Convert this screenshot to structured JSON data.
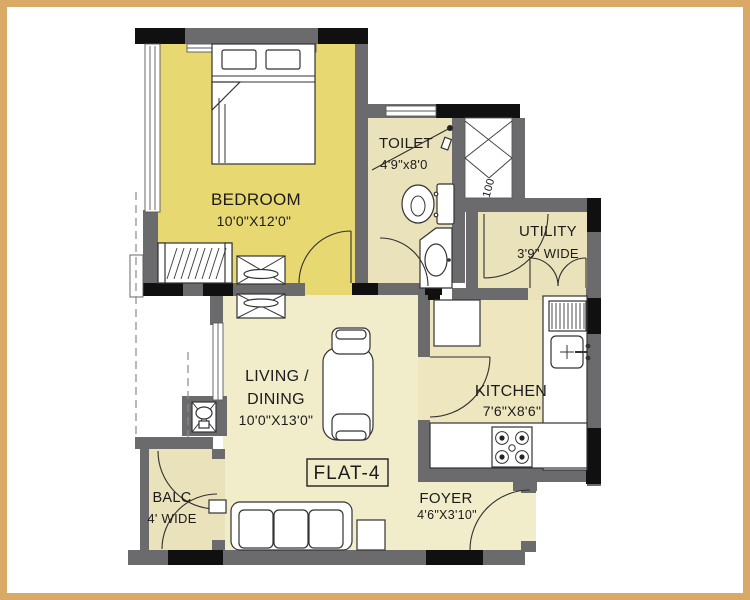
{
  "title": {
    "flat_label": "FLAT-4"
  },
  "rooms": {
    "bedroom": {
      "name": "BEDROOM",
      "dims": "10'0\"X12'0\""
    },
    "toilet": {
      "name": "TOILET",
      "dims": "4'9\"x8'0"
    },
    "utility": {
      "name": "UTILITY",
      "dims": "3'9\" WIDE"
    },
    "kitchen": {
      "name": "KITCHEN",
      "dims": "7'6\"X8'6\""
    },
    "living_dining": {
      "name_line1": "LIVING /",
      "name_line2": "DINING",
      "dims": "10'0\"X13'0\""
    },
    "balcony": {
      "name": "BALC",
      "dims": "4' WIDE"
    },
    "foyer": {
      "name": "FOYER",
      "dims": "4'6\"X3'10\""
    }
  },
  "shaft": {
    "label": "100"
  },
  "colors": {
    "frame": "#d9a967",
    "wall": "#6b6b6d",
    "column": "#101010",
    "bedroom_floor": "#e7d871",
    "wet_floor": "#eae2ba",
    "living_floor": "#f1ecca",
    "kitchen_floor": "#ede6bf",
    "fixture": "#ffffff",
    "line": "#2f2f2f"
  },
  "fixtures": {
    "bedroom": [
      "bed",
      "wardrobe",
      "tv-unit"
    ],
    "toilet": [
      "wc",
      "wash-basin"
    ],
    "kitchen": [
      "refrigerator",
      "drainboard",
      "sink",
      "hob"
    ],
    "living": [
      "dining-table",
      "dining-chair",
      "sofa",
      "side-table"
    ],
    "passage": [
      "wash-basin-niche"
    ],
    "services": [
      "duct-shaft"
    ]
  }
}
